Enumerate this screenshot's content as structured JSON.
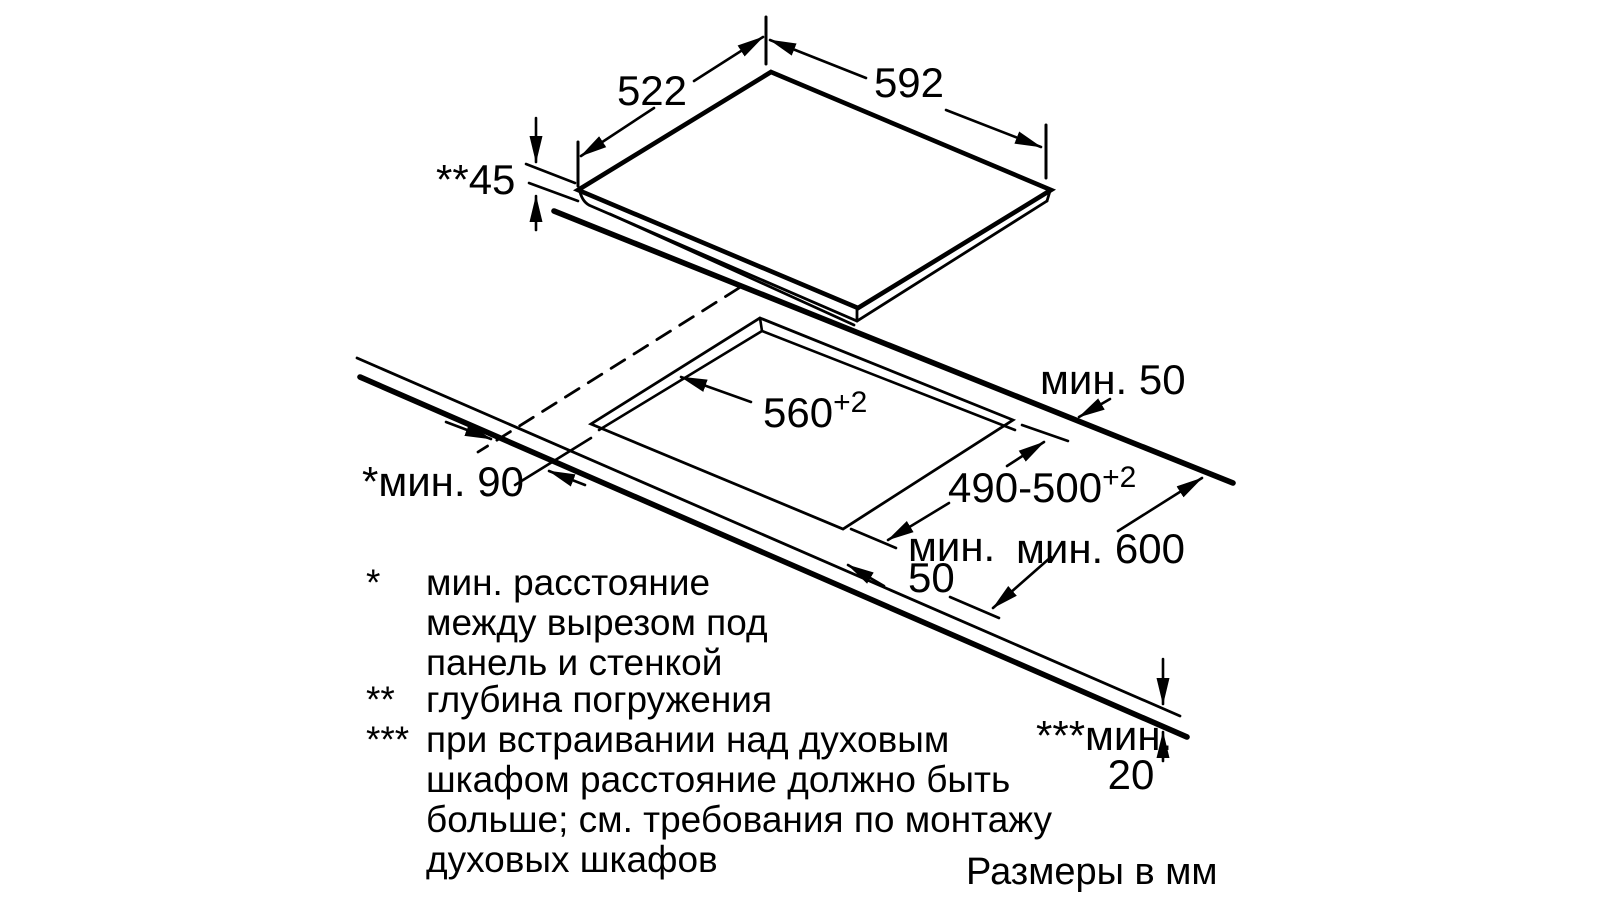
{
  "diagram": {
    "title": "cooktop-installation-dimensions",
    "units_note": "Размеры в мм",
    "dimensions": {
      "panel_depth": "522",
      "panel_width": "592",
      "panel_height": "**45",
      "cutout_width": {
        "value": "560",
        "tol": "+2"
      },
      "cutout_depth": {
        "value": "490-500",
        "tol": "+2"
      },
      "min_back_clearance": "мин. 50",
      "min_front_clearance": {
        "line1": "мин.",
        "line2": "50"
      },
      "min_wall_clearance": "*мин. 90",
      "min_worktop_depth": "мин. 600",
      "min_below_clearance": {
        "label": "***мин.",
        "value": "20"
      }
    },
    "footnotes": [
      {
        "marker": "*",
        "lines": [
          "мин. расстояние",
          "между вырезом под",
          "панель и стенкой"
        ]
      },
      {
        "marker": "**",
        "lines": [
          "глубина погружения"
        ]
      },
      {
        "marker": "***",
        "lines": [
          "при встраивании над духовым",
          "шкафом расстояние должно быть",
          "больше; см. требования по монтажу",
          "духовых шкафов"
        ]
      }
    ]
  }
}
